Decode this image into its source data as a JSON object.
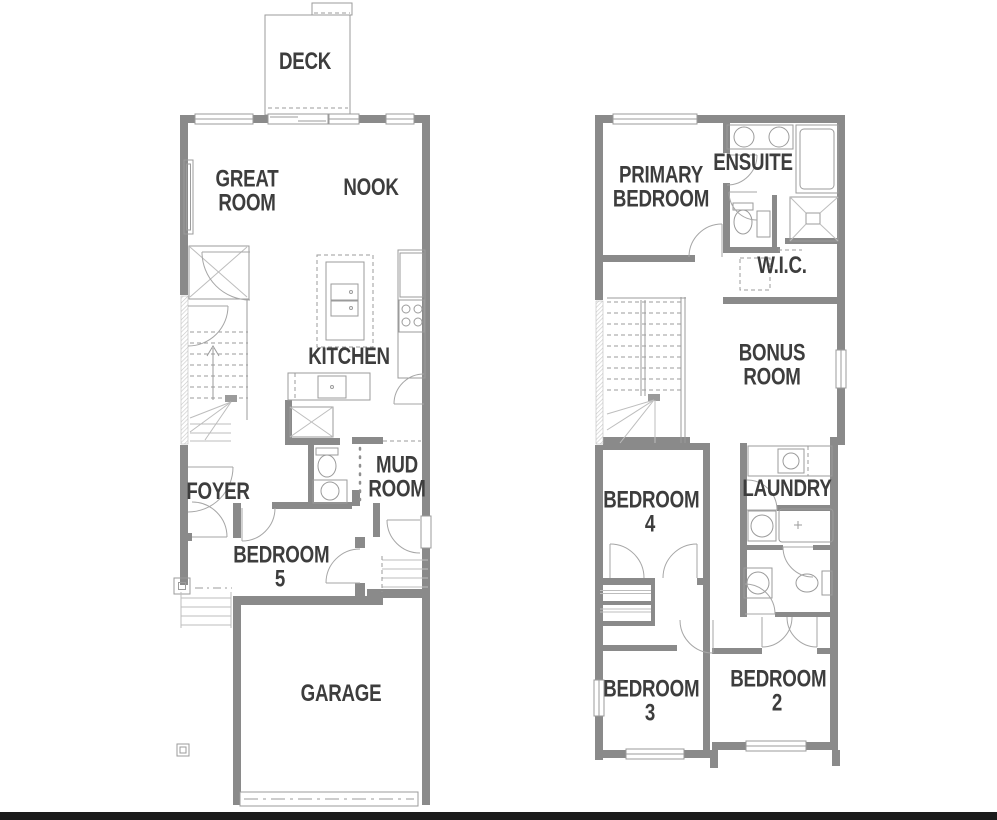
{
  "title": "Two-storey floor plan",
  "colors": {
    "wall": "#8a8a8a",
    "thin_line": "#9b9b9b",
    "light_line": "#bdbdbd",
    "label_text": "#3d3d3d",
    "footer_bar": "#1b1b1b",
    "background": "#ffffff"
  },
  "floors": {
    "main": {
      "deck": "DECK",
      "great_room": "GREAT ROOM",
      "nook": "NOOK",
      "kitchen": "KITCHEN",
      "mud_room": "MUD ROOM",
      "foyer": "FOYER",
      "bedroom5": "BEDROOM 5",
      "garage": "GARAGE"
    },
    "upper": {
      "primary_bedroom": "PRIMARY BEDROOM",
      "ensuite": "ENSUITE",
      "wic": "W.I.C.",
      "bonus_room": "BONUS ROOM",
      "bedroom4": "BEDROOM 4",
      "laundry": "LAUNDRY",
      "bedroom3": "BEDROOM 3",
      "bedroom2": "BEDROOM 2"
    }
  }
}
